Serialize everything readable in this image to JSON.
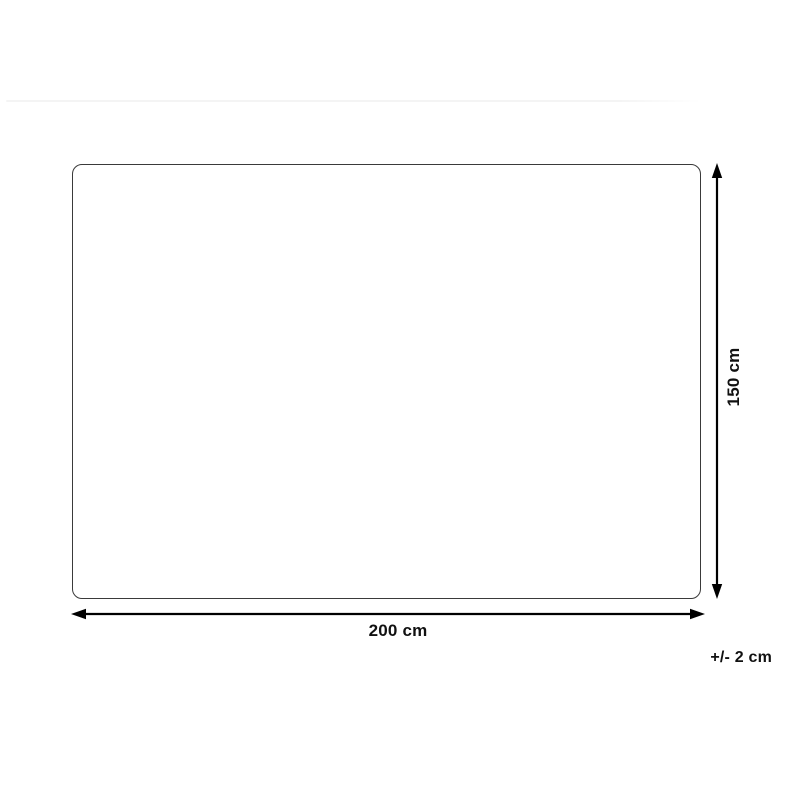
{
  "page": {
    "background": "#ffffff"
  },
  "diagram": {
    "type": "product-dimension-drawing",
    "shape": {
      "description": "rounded rectangle outline (top-down product view)",
      "border_color": "#3a3a3a",
      "fill": "#ffffff"
    },
    "arrow_color": "#000000",
    "dimensions": {
      "width": {
        "value": "200 cm"
      },
      "height": {
        "value": "150 cm"
      },
      "tolerance": {
        "value": "+/- 2 cm"
      }
    }
  }
}
